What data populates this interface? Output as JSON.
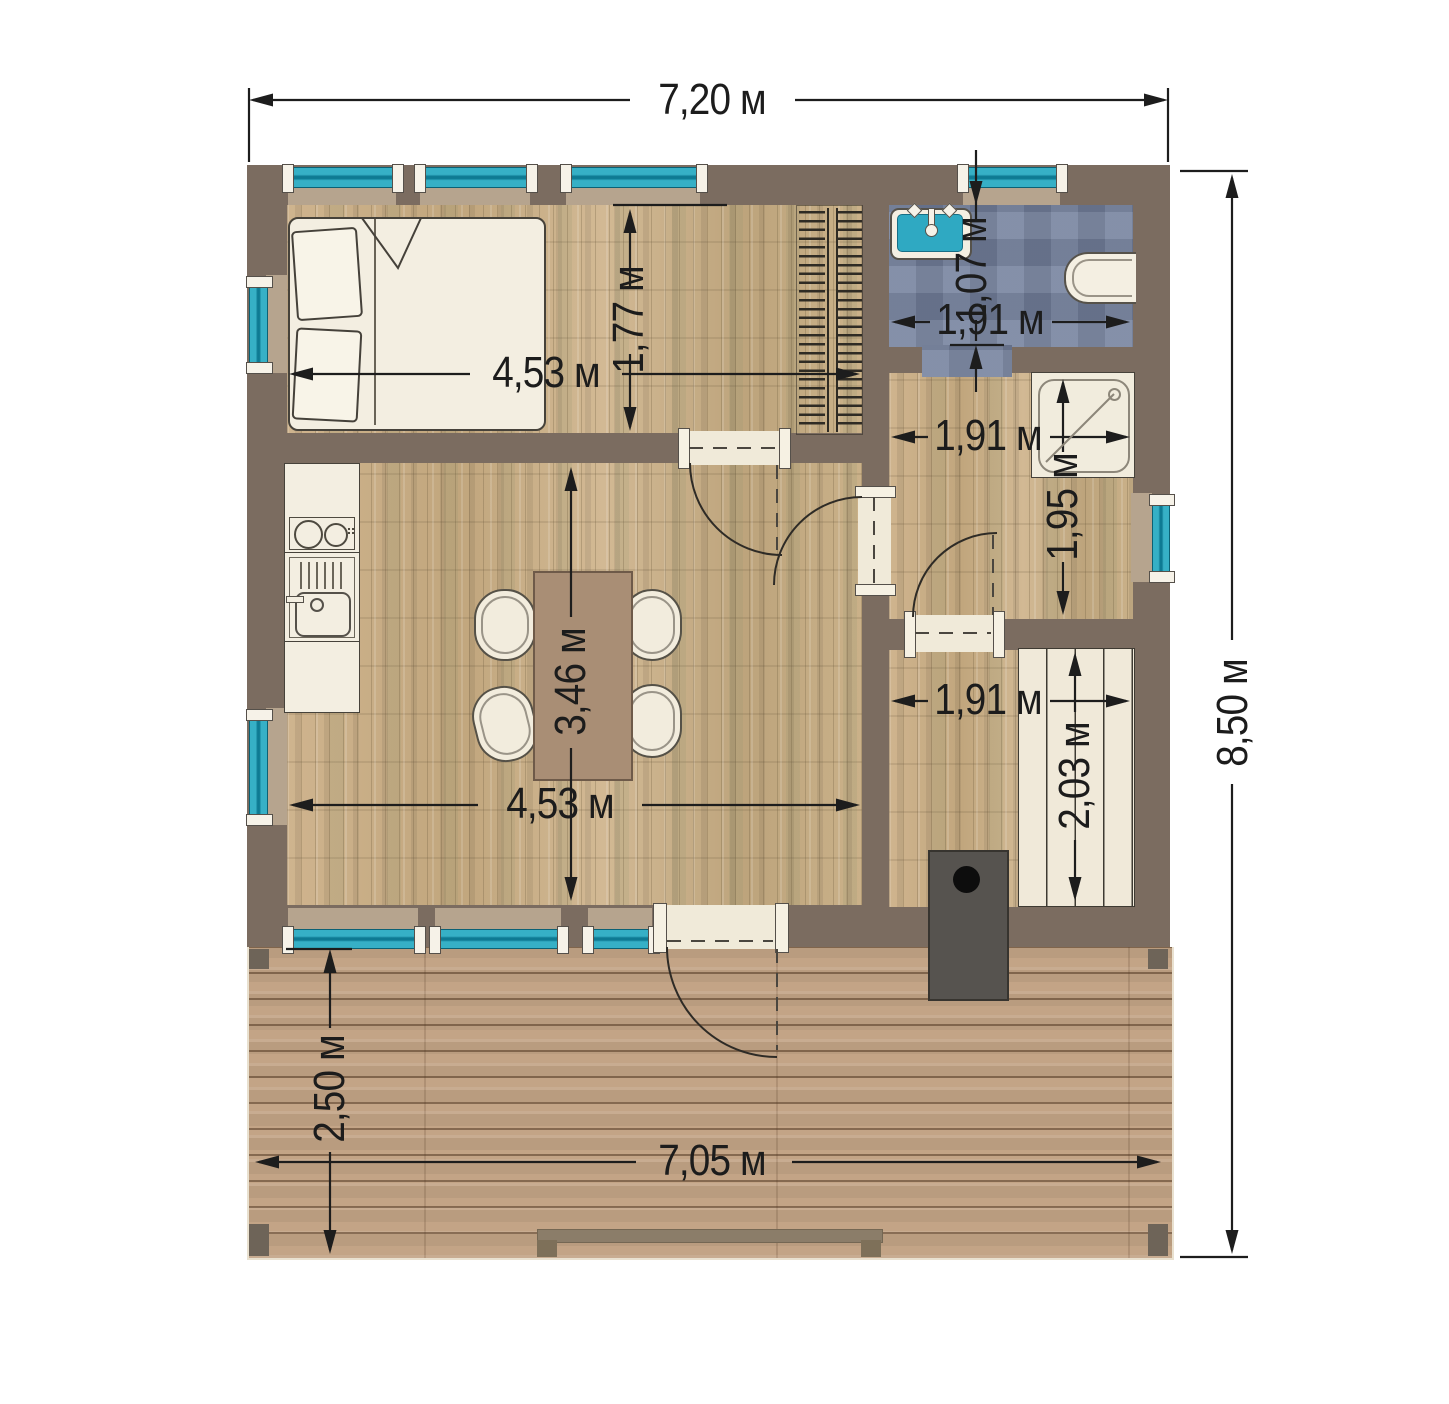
{
  "plan": {
    "type": "floor-plan",
    "units": "м",
    "dimensions": {
      "overall_width": "7,20 м",
      "overall_depth": "8,50 м",
      "bedroom_width": "4,53 м",
      "bedroom_depth": "1,77 м",
      "bathroom_depth": "1,07 м",
      "bathroom_width": "1,91 м",
      "hall_width": "1,91 м",
      "hall_depth": "1,95 м",
      "sauna_width": "1,91 м",
      "sauna_bench_depth": "2,03 м",
      "living_width": "4,53 м",
      "living_depth": "3,46 м",
      "terrace_width": "7,05 м",
      "terrace_depth": "2,50 м"
    },
    "colors": {
      "wall": "#7b6c60",
      "wood_floor": "#c8ae88",
      "terrace_wood": "#c3a486",
      "bathroom_tile": "#75829e",
      "window_glass": "#2aa9c0",
      "sink_accent": "#2fa9c2",
      "stove": "#56534f",
      "dimension_ink": "#1d1d1d"
    }
  }
}
